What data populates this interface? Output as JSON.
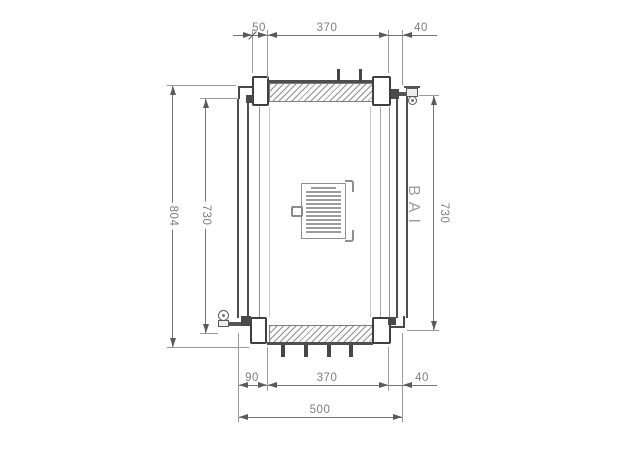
{
  "drawing": {
    "type": "technical-drawing-radiator-plan",
    "watermark": "BAI",
    "dimensions": {
      "top": {
        "d50": "50",
        "d370": "370",
        "d40": "40"
      },
      "bottom": {
        "d90": "90",
        "d370": "370",
        "d40": "40",
        "d500": "500"
      },
      "left": {
        "outer": "804",
        "inner": "730"
      },
      "right": {
        "d730": "730"
      }
    }
  }
}
